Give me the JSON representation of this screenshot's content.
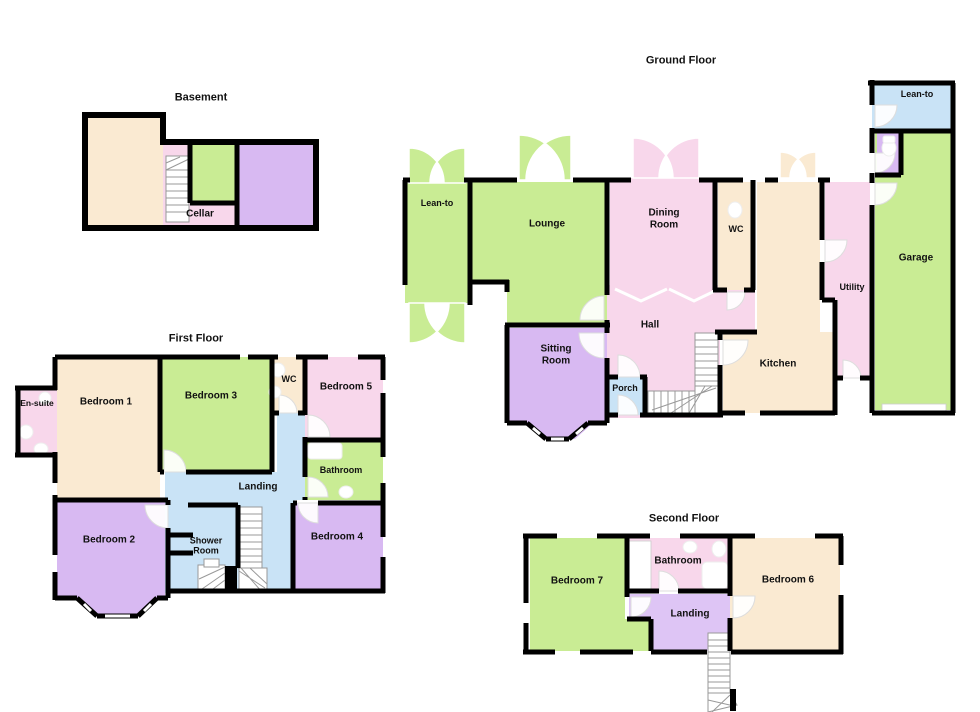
{
  "palette": {
    "wall": "#000000",
    "cream_room": "#FAEAD2",
    "green_room": "#C9EC94",
    "pink_room": "#F8D7EB",
    "purple_room": "#D8B9F2",
    "blue_room": "#C9E3F6",
    "lavender_room": "#DEC5F5",
    "stair_line": "#999999",
    "background": "#ffffff",
    "label_text": "#111111"
  },
  "floors": {
    "basement": {
      "title": "Basement",
      "rooms": {
        "cellar": "Cellar"
      }
    },
    "first": {
      "title": "First Floor",
      "rooms": {
        "ensuite": "En-suite",
        "bedroom1": "Bedroom 1",
        "bedroom2": "Bedroom 2",
        "bedroom3": "Bedroom 3",
        "bedroom4": "Bedroom 4",
        "bedroom5": "Bedroom 5",
        "wc": "WC",
        "bathroom": "Bathroom",
        "landing": "Landing",
        "shower": "Shower Room"
      }
    },
    "ground": {
      "title": "Ground Floor",
      "rooms": {
        "lean_to_left": "Lean-to",
        "lounge": "Lounge",
        "dining": "Dining Room",
        "sitting": "Sitting Room",
        "hall": "Hall",
        "porch": "Porch",
        "wc": "WC",
        "kitchen": "Kitchen",
        "utility": "Utility",
        "garage": "Garage",
        "lean_to_right": "Lean-to"
      }
    },
    "second": {
      "title": "Second Floor",
      "rooms": {
        "bedroom7": "Bedroom 7",
        "bathroom": "Bathroom",
        "bedroom6": "Bedroom 6",
        "landing": "Landing"
      }
    }
  }
}
